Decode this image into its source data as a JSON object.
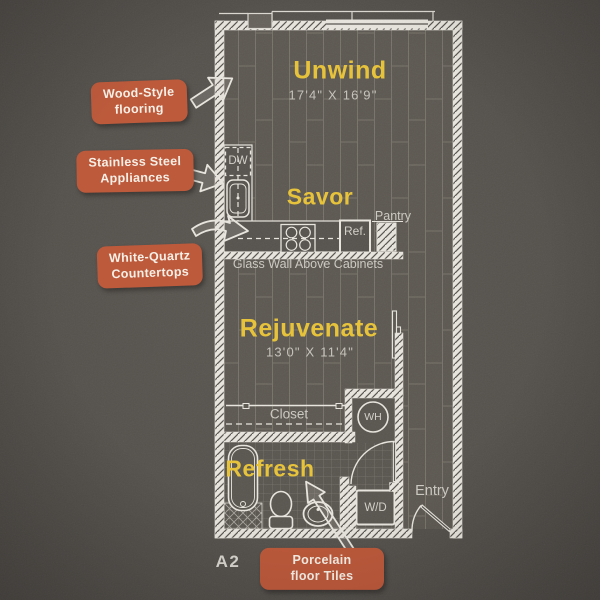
{
  "plan_code": "A2",
  "rooms": {
    "unwind": {
      "title": "Unwind",
      "dims": "17'4\" X 16'9\""
    },
    "savor": {
      "title": "Savor"
    },
    "rejuvenate": {
      "title": "Rejuvenate",
      "dims": "13'0\" X 11'4\""
    },
    "refresh": {
      "title": "Refresh"
    }
  },
  "labels": {
    "dw": "DW",
    "ref": "Ref.",
    "pantry": "Pantry",
    "glass_wall": "Glass Wall Above Cabinets",
    "closet": "Closet",
    "wh": "WH",
    "wd": "W/D",
    "entry": "Entry"
  },
  "callouts": {
    "flooring": {
      "line1": "Wood-Style",
      "line2": "flooring"
    },
    "appliances": {
      "line1": "Stainless Steel",
      "line2": "Appliances"
    },
    "countertops": {
      "line1": "White-Quartz",
      "line2": "Countertops"
    },
    "tiles": {
      "line1": "Porcelain",
      "line2": "floor Tiles"
    }
  },
  "colors": {
    "background": "#55514c",
    "accent_yellow": "#e7c33c",
    "callout_red": "#bd5a3c",
    "line_white": "#e9e6df",
    "text_light": "#c9c6bf"
  }
}
